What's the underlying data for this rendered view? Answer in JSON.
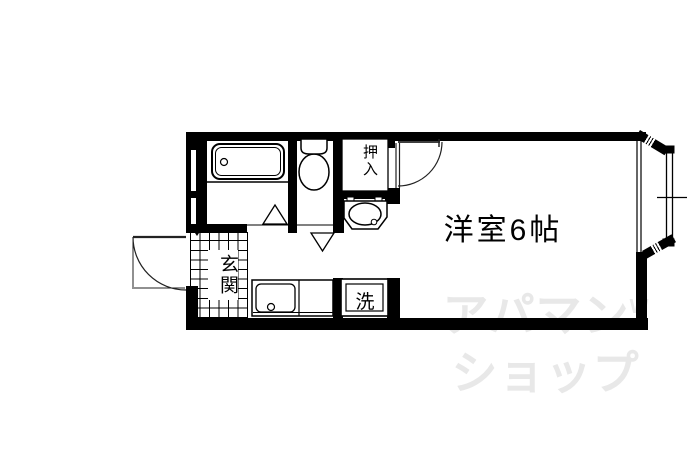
{
  "plan": {
    "room_label": "洋室6帖",
    "entrance_label": "玄関",
    "closet_label": "押入",
    "laundry_label": "洗"
  },
  "watermark": {
    "line1": "アパマン",
    "mark": "W",
    "line2": "ショップ"
  },
  "colors": {
    "wall": "#000000",
    "watermark": "#e8e8e8",
    "background": "#ffffff"
  }
}
